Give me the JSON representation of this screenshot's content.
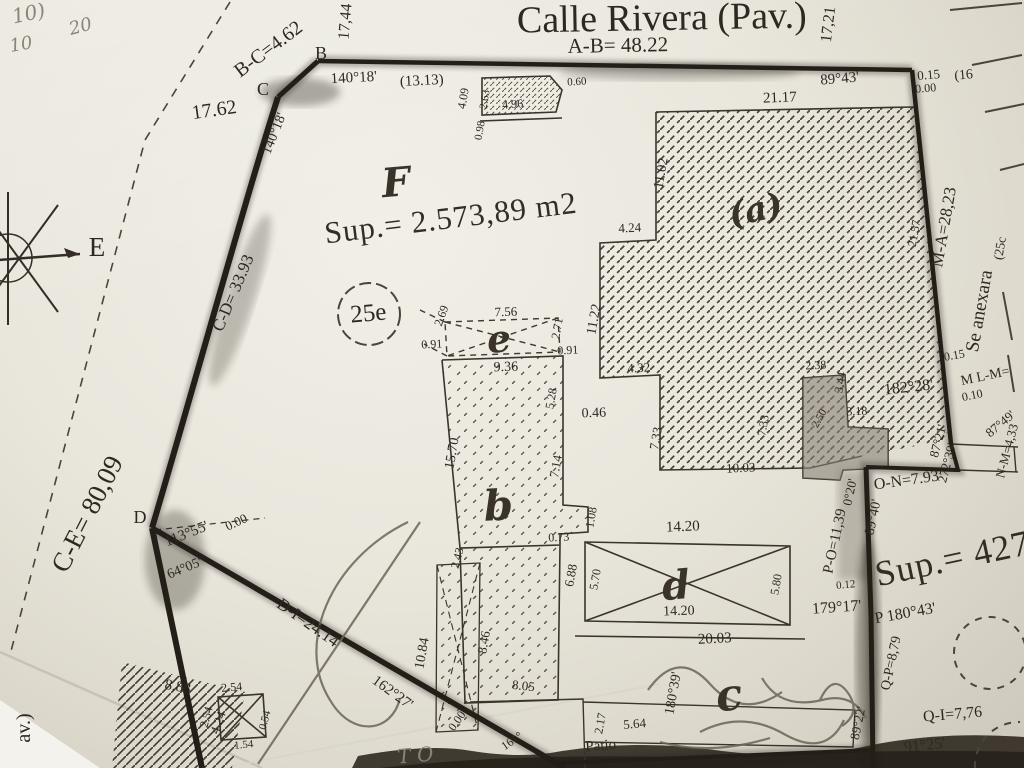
{
  "summary": {
    "street": "Calle Rivera (Pav.)",
    "front_measure": "A-B= 48.22",
    "main_area": "Sup.= 2.573,89 m2",
    "annex_area": "Sup.= 427",
    "lot_circle": "25e",
    "annex_note": "Se anexara",
    "parcel_letter_main": "F",
    "adjacent_lot": "(25c",
    "adjacent_ref": "(16"
  },
  "texts": [
    {
      "t": "Calle Rivera (Pav.)",
      "x": 662,
      "y": 30,
      "r": -1,
      "s": 38,
      "n": "street-name"
    },
    {
      "t": "A-B= 48.22",
      "x": 618,
      "y": 52,
      "r": -1,
      "s": 21,
      "n": "dim-a-b"
    },
    {
      "t": "17,44",
      "x": 350,
      "y": 22,
      "r": -85,
      "s": 16
    },
    {
      "t": "17,21",
      "x": 833,
      "y": 25,
      "r": -83,
      "s": 16
    },
    {
      "t": "B",
      "x": 321,
      "y": 59,
      "r": 0,
      "s": 18,
      "n": "vertex-b"
    },
    {
      "t": "C",
      "x": 263,
      "y": 95,
      "r": 0,
      "s": 18,
      "n": "vertex-c"
    },
    {
      "t": "B-C=4.62",
      "x": 272,
      "y": 54,
      "r": -37,
      "s": 20,
      "n": "dim-b-c"
    },
    {
      "t": "17.62",
      "x": 215,
      "y": 116,
      "r": -8,
      "s": 20
    },
    {
      "t": "140°18'",
      "x": 354,
      "y": 82,
      "r": -3,
      "s": 15
    },
    {
      "t": "(13.13)",
      "x": 422,
      "y": 85,
      "r": -3,
      "s": 15
    },
    {
      "t": "89°43'",
      "x": 840,
      "y": 83,
      "r": -5,
      "s": 15
    },
    {
      "t": "140°18'",
      "x": 278,
      "y": 135,
      "r": -68,
      "s": 14
    },
    {
      "t": "C-D= 33.93",
      "x": 238,
      "y": 295,
      "r": -67,
      "s": 17,
      "n": "dim-c-d"
    },
    {
      "t": "E",
      "x": 97,
      "y": 256,
      "r": 0,
      "s": 27,
      "n": "compass-east-label"
    },
    {
      "t": "C-E= 80,09",
      "x": 95,
      "y": 518,
      "r": -63,
      "s": 27,
      "n": "dim-c-e"
    },
    {
      "t": "D",
      "x": 140,
      "y": 523,
      "r": 0,
      "s": 18,
      "n": "vertex-d"
    },
    {
      "t": "113°55'",
      "x": 188,
      "y": 538,
      "r": -22,
      "s": 15
    },
    {
      "t": "0.00",
      "x": 238,
      "y": 526,
      "r": -25,
      "s": 13
    },
    {
      "t": "64°05'",
      "x": 186,
      "y": 572,
      "r": -22,
      "s": 14
    },
    {
      "t": "D-I=24.14",
      "x": 305,
      "y": 627,
      "r": 35,
      "s": 17,
      "n": "dim-d-i"
    },
    {
      "t": "162°27'",
      "x": 390,
      "y": 696,
      "r": 36,
      "s": 15
    },
    {
      "t": "0.00",
      "x": 460,
      "y": 723,
      "r": -55,
      "s": 12
    },
    {
      "t": "4.09",
      "x": 467,
      "y": 99,
      "r": -80,
      "s": 12
    },
    {
      "t": "2.63",
      "x": 488,
      "y": 100,
      "r": -80,
      "s": 11
    },
    {
      "t": "4.96",
      "x": 513,
      "y": 108,
      "r": -5,
      "s": 12
    },
    {
      "t": "0.60",
      "x": 577,
      "y": 85,
      "r": -3,
      "s": 11
    },
    {
      "t": "0.98",
      "x": 483,
      "y": 131,
      "r": -80,
      "s": 11
    },
    {
      "t": "21.17",
      "x": 780,
      "y": 102,
      "r": -2,
      "s": 15
    },
    {
      "t": "11.02",
      "x": 665,
      "y": 174,
      "r": -80,
      "s": 14
    },
    {
      "t": "4.24",
      "x": 630,
      "y": 232,
      "r": -3,
      "s": 13
    },
    {
      "t": "11.22",
      "x": 598,
      "y": 320,
      "r": -80,
      "s": 14
    },
    {
      "t": "4.32",
      "x": 639,
      "y": 372,
      "r": -3,
      "s": 13
    },
    {
      "t": "7.33",
      "x": 660,
      "y": 439,
      "r": -80,
      "s": 13
    },
    {
      "t": "10.03",
      "x": 741,
      "y": 472,
      "r": -3,
      "s": 13
    },
    {
      "t": "7.56",
      "x": 506,
      "y": 316,
      "r": -2,
      "s": 13
    },
    {
      "t": "2.69",
      "x": 445,
      "y": 317,
      "r": -70,
      "s": 12
    },
    {
      "t": "0.91",
      "x": 432,
      "y": 348,
      "r": -3,
      "s": 12
    },
    {
      "t": "2.71",
      "x": 561,
      "y": 329,
      "r": -80,
      "s": 12
    },
    {
      "t": "0.91",
      "x": 568,
      "y": 354,
      "r": -3,
      "s": 12
    },
    {
      "t": "9.36",
      "x": 506,
      "y": 371,
      "r": -2,
      "s": 14
    },
    {
      "t": "5.28",
      "x": 555,
      "y": 399,
      "r": -80,
      "s": 12
    },
    {
      "t": "0.46",
      "x": 594,
      "y": 417,
      "r": -2,
      "s": 14
    },
    {
      "t": "15.70",
      "x": 456,
      "y": 454,
      "r": -80,
      "s": 14
    },
    {
      "t": "7.14",
      "x": 560,
      "y": 467,
      "r": -80,
      "s": 13
    },
    {
      "t": "1.08",
      "x": 595,
      "y": 518,
      "r": -80,
      "s": 12
    },
    {
      "t": "0.73",
      "x": 559,
      "y": 541,
      "r": -3,
      "s": 12
    },
    {
      "t": "2.43",
      "x": 461,
      "y": 559,
      "r": -75,
      "s": 12
    },
    {
      "t": "8.46",
      "x": 488,
      "y": 643,
      "r": -80,
      "s": 13
    },
    {
      "t": "10.84",
      "x": 426,
      "y": 654,
      "r": -80,
      "s": 14
    },
    {
      "t": "8.05",
      "x": 523,
      "y": 690,
      "r": 6,
      "s": 13
    },
    {
      "t": "6.88",
      "x": 575,
      "y": 576,
      "r": -80,
      "s": 13
    },
    {
      "t": "5.70",
      "x": 599,
      "y": 580,
      "r": -80,
      "s": 12
    },
    {
      "t": "5.80",
      "x": 780,
      "y": 585,
      "r": -80,
      "s": 12
    },
    {
      "t": "14.20",
      "x": 683,
      "y": 531,
      "r": -2,
      "s": 15
    },
    {
      "t": "14.20",
      "x": 679,
      "y": 615,
      "r": -2,
      "s": 14
    },
    {
      "t": "20.03",
      "x": 715,
      "y": 643,
      "r": -3,
      "s": 15
    },
    {
      "t": "2.38",
      "x": 816,
      "y": 369,
      "r": -3,
      "s": 12
    },
    {
      "t": "3.44",
      "x": 844,
      "y": 383,
      "r": -80,
      "s": 12
    },
    {
      "t": "3.18",
      "x": 857,
      "y": 415,
      "r": -2,
      "s": 12
    },
    {
      "t": "7.33",
      "x": 767,
      "y": 426,
      "r": -80,
      "s": 12
    },
    {
      "t": "2.50",
      "x": 822,
      "y": 420,
      "r": -60,
      "s": 11
    },
    {
      "t": "0.15",
      "x": 929,
      "y": 79,
      "r": -5,
      "s": 13
    },
    {
      "t": "(16",
      "x": 964,
      "y": 79,
      "r": -5,
      "s": 14,
      "n": "adjacent-ref"
    },
    {
      "t": "0.00",
      "x": 926,
      "y": 92,
      "r": -5,
      "s": 12
    },
    {
      "t": "M-A=28,23",
      "x": 949,
      "y": 228,
      "r": -80,
      "s": 17,
      "n": "dim-m-a"
    },
    {
      "t": "21.57",
      "x": 918,
      "y": 234,
      "r": -80,
      "s": 12
    },
    {
      "t": "(25c",
      "x": 1004,
      "y": 249,
      "r": -80,
      "s": 13,
      "n": "adjacent-lot"
    },
    {
      "t": "Se anexara",
      "x": 985,
      "y": 312,
      "r": -80,
      "s": 19,
      "n": "annex-note"
    },
    {
      "t": "0.15",
      "x": 955,
      "y": 359,
      "r": -10,
      "s": 12
    },
    {
      "t": "M L-M=",
      "x": 986,
      "y": 380,
      "r": -12,
      "s": 14,
      "n": "dim-l-m"
    },
    {
      "t": "0.10",
      "x": 973,
      "y": 399,
      "r": -12,
      "s": 12
    },
    {
      "t": "182°28'",
      "x": 909,
      "y": 392,
      "r": -6,
      "s": 16
    },
    {
      "t": "87°21'",
      "x": 942,
      "y": 442,
      "r": -75,
      "s": 13
    },
    {
      "t": "272°39'",
      "x": 951,
      "y": 464,
      "r": -75,
      "s": 13
    },
    {
      "t": "87°49'",
      "x": 1003,
      "y": 427,
      "r": -40,
      "s": 13
    },
    {
      "t": "N-M=4,33",
      "x": 1011,
      "y": 452,
      "r": -75,
      "s": 13,
      "n": "dim-n-m"
    },
    {
      "t": "O-N=7.93",
      "x": 907,
      "y": 485,
      "r": -8,
      "s": 16,
      "n": "dim-o-n"
    },
    {
      "t": "0°20'",
      "x": 854,
      "y": 493,
      "r": -78,
      "s": 13
    },
    {
      "t": "89°40'",
      "x": 877,
      "y": 518,
      "r": -78,
      "s": 14
    },
    {
      "t": "P-O=11,39",
      "x": 839,
      "y": 542,
      "r": -78,
      "s": 15,
      "n": "dim-p-o"
    },
    {
      "t": "0.12",
      "x": 846,
      "y": 588,
      "r": -5,
      "s": 11
    },
    {
      "t": "179°17'",
      "x": 837,
      "y": 612,
      "r": -4,
      "s": 16
    },
    {
      "t": "P 180°43'",
      "x": 906,
      "y": 618,
      "r": -10,
      "s": 16,
      "n": "vertex-p"
    },
    {
      "t": "Q-P=8,79",
      "x": 895,
      "y": 664,
      "r": -78,
      "s": 14,
      "n": "dim-q-p"
    },
    {
      "t": "89°22'",
      "x": 862,
      "y": 724,
      "r": -78,
      "s": 13
    },
    {
      "t": "Q-I=7,76",
      "x": 953,
      "y": 719,
      "r": -5,
      "s": 16,
      "n": "dim-q-i"
    },
    {
      "t": "91°25'",
      "x": 925,
      "y": 750,
      "r": -6,
      "s": 16
    },
    {
      "t": "Sup.= 427",
      "x": 955,
      "y": 570,
      "r": -12,
      "s": 36,
      "c": "ink-big",
      "n": "area-annex"
    },
    {
      "t": "Sup.= 2.573,89 m2",
      "x": 452,
      "y": 228,
      "r": -7,
      "s": 31,
      "c": "ink-big",
      "n": "area-main"
    },
    {
      "t": "25e",
      "x": 369,
      "y": 321,
      "r": -5,
      "s": 25,
      "n": "lot-circle-label"
    },
    {
      "t": "8.88",
      "x": 177,
      "y": 691,
      "r": 10,
      "s": 15
    },
    {
      "t": "4.24",
      "x": 222,
      "y": 724,
      "r": -70,
      "s": 13
    },
    {
      "t": "2.54",
      "x": 232,
      "y": 691,
      "r": -5,
      "s": 12
    },
    {
      "t": "2.54",
      "x": 210,
      "y": 718,
      "r": -75,
      "s": 12
    },
    {
      "t": "0.54",
      "x": 268,
      "y": 721,
      "r": -75,
      "s": 11
    },
    {
      "t": "1.54",
      "x": 244,
      "y": 748,
      "r": -5,
      "s": 11
    },
    {
      "t": "Patio",
      "x": 601,
      "y": 750,
      "r": -4,
      "s": 15,
      "n": "patio-label"
    },
    {
      "t": "5.64",
      "x": 635,
      "y": 728,
      "r": -5,
      "s": 13
    },
    {
      "t": "2.17",
      "x": 604,
      "y": 724,
      "r": -80,
      "s": 12
    },
    {
      "t": "180°39'",
      "x": 677,
      "y": 694,
      "r": -80,
      "s": 14
    },
    {
      "t": "161°",
      "x": 514,
      "y": 744,
      "r": -35,
      "s": 12
    },
    {
      "t": "av.)",
      "x": 30,
      "y": 728,
      "r": -90,
      "s": 20,
      "n": "left-street-fragment"
    }
  ],
  "handwritten": [
    {
      "t": "F",
      "x": 397,
      "y": 196,
      "r": -5,
      "s": 40,
      "c": "hand",
      "n": "parcel-letter-f"
    },
    {
      "t": "e",
      "x": 500,
      "y": 352,
      "r": -5,
      "s": 38,
      "c": "hand",
      "n": "parcel-letter-e"
    },
    {
      "t": "b",
      "x": 499,
      "y": 520,
      "r": -3,
      "s": 42,
      "c": "hand",
      "n": "parcel-letter-b"
    },
    {
      "t": "d",
      "x": 677,
      "y": 599,
      "r": -5,
      "s": 40,
      "c": "hand",
      "n": "parcel-letter-d"
    },
    {
      "t": "c",
      "x": 731,
      "y": 710,
      "r": -8,
      "s": 44,
      "c": "hand",
      "n": "parcel-letter-c"
    },
    {
      "t": "(a)",
      "x": 758,
      "y": 221,
      "r": -12,
      "s": 34,
      "c": "hand",
      "n": "parcel-letter-a"
    },
    {
      "t": "10)",
      "x": 30,
      "y": 20,
      "r": -12,
      "s": 20,
      "c": "pencil"
    },
    {
      "t": "20",
      "x": 82,
      "y": 32,
      "r": -15,
      "s": 18,
      "c": "pencil"
    },
    {
      "t": "10",
      "x": 22,
      "y": 50,
      "r": -10,
      "s": 18,
      "c": "pencil"
    },
    {
      "t": "T O",
      "x": 416,
      "y": 762,
      "r": -5,
      "s": 20,
      "c": "pencil"
    }
  ]
}
